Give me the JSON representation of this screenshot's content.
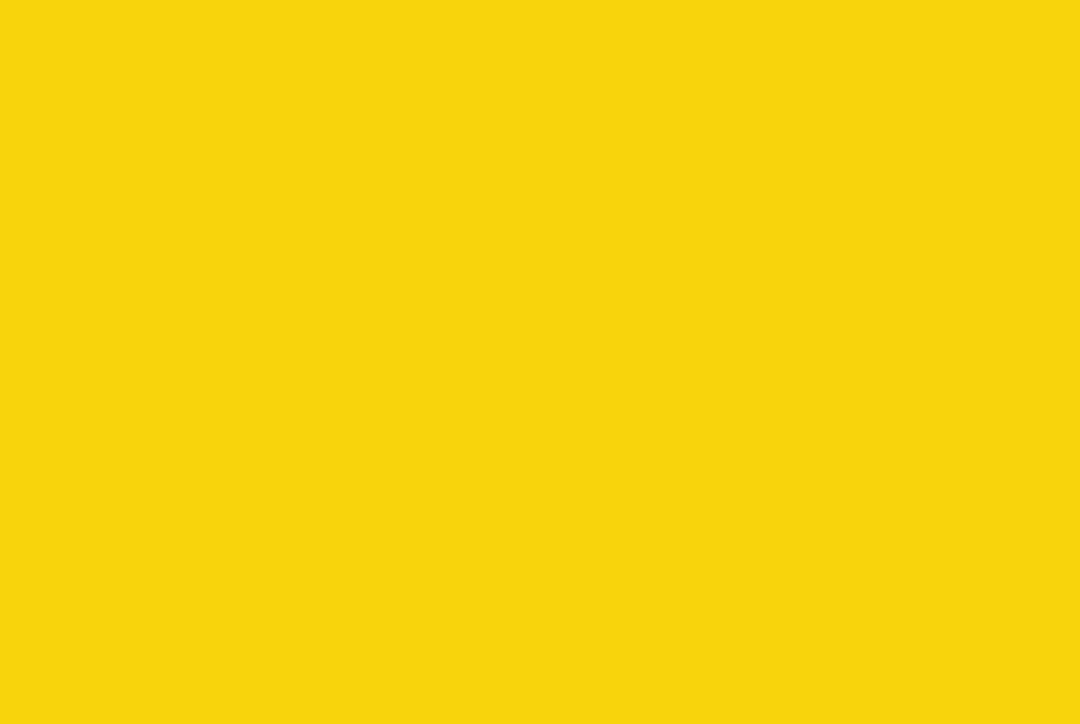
{
  "page": {
    "background_color": "#F5D409",
    "caption": "点击查看大图"
  },
  "colors": {
    "route_red": "#d42a1e",
    "route_secondary": "#5a3bb5",
    "chip_yellow_bg": "#FFE600",
    "chip_yellow_text": "#8a2a1e",
    "chip_blue_bg": "#1f1fd4",
    "chip_blue_text": "#ffffff",
    "chip_blue_count": "#ffd84d",
    "pin_purple": "#6a2fa0",
    "km_text": "#ffd800",
    "start_finish_red": "#e02020",
    "water_blue": "#5d84b8",
    "park_green": "#aecb7e"
  },
  "map": {
    "start_finish": {
      "text": "起终点",
      "x": 483,
      "y": 452
    },
    "km_markers": [
      {
        "text": "1KM",
        "x": 240,
        "y": 276
      },
      {
        "text": "2KM",
        "x": 404,
        "y": 99
      },
      {
        "text": "3KM",
        "x": 787,
        "y": 131
      },
      {
        "text": "4KM",
        "x": 911,
        "y": 120
      },
      {
        "text": "5KM",
        "x": 466,
        "y": 406
      }
    ],
    "count_chips": [
      {
        "text": "×1",
        "x": 72,
        "y": 132,
        "person": "R"
      },
      {
        "text": "×2",
        "x": 142,
        "y": 185,
        "person": "R"
      },
      {
        "text": "×1",
        "x": 235,
        "y": 223,
        "person": "R"
      },
      {
        "text": "×1",
        "x": 147,
        "y": 315,
        "person": "R"
      },
      {
        "text": "×5",
        "x": 399,
        "y": 160,
        "person": "R"
      },
      {
        "text": "×1",
        "x": 488,
        "y": 210,
        "person": "L"
      },
      {
        "text": "×2",
        "x": 441,
        "y": 87,
        "person": "L"
      },
      {
        "text": "×1",
        "x": 500,
        "y": 110,
        "person": "L"
      },
      {
        "text": "×1",
        "x": 707,
        "y": 104,
        "person": "L"
      },
      {
        "text": "×2",
        "x": 876,
        "y": 106,
        "person": "R"
      },
      {
        "text": "×1",
        "x": 779,
        "y": 139,
        "person": "R"
      },
      {
        "text": "×1",
        "x": 752,
        "y": 187,
        "person": "L"
      },
      {
        "text": "×1",
        "x": 913,
        "y": 186,
        "person": "L"
      },
      {
        "text": "×1",
        "x": 617,
        "y": 294,
        "person": "L"
      },
      {
        "text": "×5",
        "x": 707,
        "y": 293,
        "person": "L"
      },
      {
        "text": "×1",
        "x": 758,
        "y": 299,
        "person": "L"
      },
      {
        "text": "×1",
        "x": 639,
        "y": 317,
        "person": "L"
      },
      {
        "text": "×1",
        "x": 546,
        "y": 324,
        "person": "L"
      },
      {
        "text": "×1",
        "x": 890,
        "y": 324,
        "person": "L"
      },
      {
        "text": "×2",
        "x": 341,
        "y": 258,
        "person": "L"
      },
      {
        "text": "×1",
        "x": 303,
        "y": 312,
        "person": "L"
      },
      {
        "text": "×1",
        "x": 325,
        "y": 387,
        "person": "R"
      },
      {
        "text": "×1",
        "x": 449,
        "y": 408,
        "person": "R"
      },
      {
        "text": "×1",
        "x": 388,
        "y": 430,
        "person": "R"
      },
      {
        "text": "×2",
        "x": 437,
        "y": 439,
        "person": "R"
      },
      {
        "text": "×5",
        "x": 522,
        "y": 356,
        "person": "R"
      },
      {
        "text": "×2",
        "x": 562,
        "y": 244,
        "person": "L"
      },
      {
        "text": "×1",
        "x": 595,
        "y": 255,
        "person": "L"
      },
      {
        "text": "×1",
        "x": 759,
        "y": 333,
        "person": "L"
      }
    ],
    "barrier_chips": [
      {
        "text": "铁马×5",
        "x": 100,
        "y": 134,
        "pin": true
      },
      {
        "text": "铁马×3",
        "x": 202,
        "y": 182,
        "pin": true
      },
      {
        "text": "铁马×3",
        "x": 234,
        "y": 202,
        "pin": true
      },
      {
        "text": "铁马×5",
        "x": 267,
        "y": 219,
        "pin": true
      },
      {
        "text": "铁马×10",
        "x": 441,
        "y": 75,
        "pin": true
      },
      {
        "text": "铁马×20",
        "x": 442,
        "y": 186,
        "pin": true
      },
      {
        "text": "锥桶×6",
        "x": 442,
        "y": 199,
        "pin": false
      },
      {
        "text": "锥桶×25",
        "x": 518,
        "y": 245,
        "pin": true
      },
      {
        "text": "铁马×3",
        "x": 561,
        "y": 268,
        "pin": true
      },
      {
        "text": "铁马×1",
        "x": 628,
        "y": 202,
        "pin": true
      },
      {
        "text": "铁马×4",
        "x": 694,
        "y": 172,
        "pin": true
      },
      {
        "text": "铁马×4",
        "x": 727,
        "y": 157,
        "pin": true
      },
      {
        "text": "铁马×2",
        "x": 770,
        "y": 177,
        "pin": true
      },
      {
        "text": "铁马×2",
        "x": 800,
        "y": 164,
        "pin": true
      },
      {
        "text": "铁马×2",
        "x": 847,
        "y": 129,
        "pin": true
      },
      {
        "text": "铁马×3",
        "x": 708,
        "y": 85,
        "pin": true
      },
      {
        "text": "铁马×8",
        "x": 907,
        "y": 107,
        "pin": true
      }
    ],
    "service_stations": [
      {
        "x": 375,
        "y": 176,
        "bar": false,
        "icons": [
          "toilet",
          "info",
          "supply",
          "medical"
        ]
      },
      {
        "x": 684,
        "y": 320,
        "bar": true,
        "icons": [
          "toilet",
          "info",
          "supply",
          "medical"
        ]
      }
    ],
    "compass": {
      "north_label": "N",
      "scale_labels": [
        "0m",
        "50m",
        "100m",
        "150m",
        "200m"
      ]
    }
  }
}
